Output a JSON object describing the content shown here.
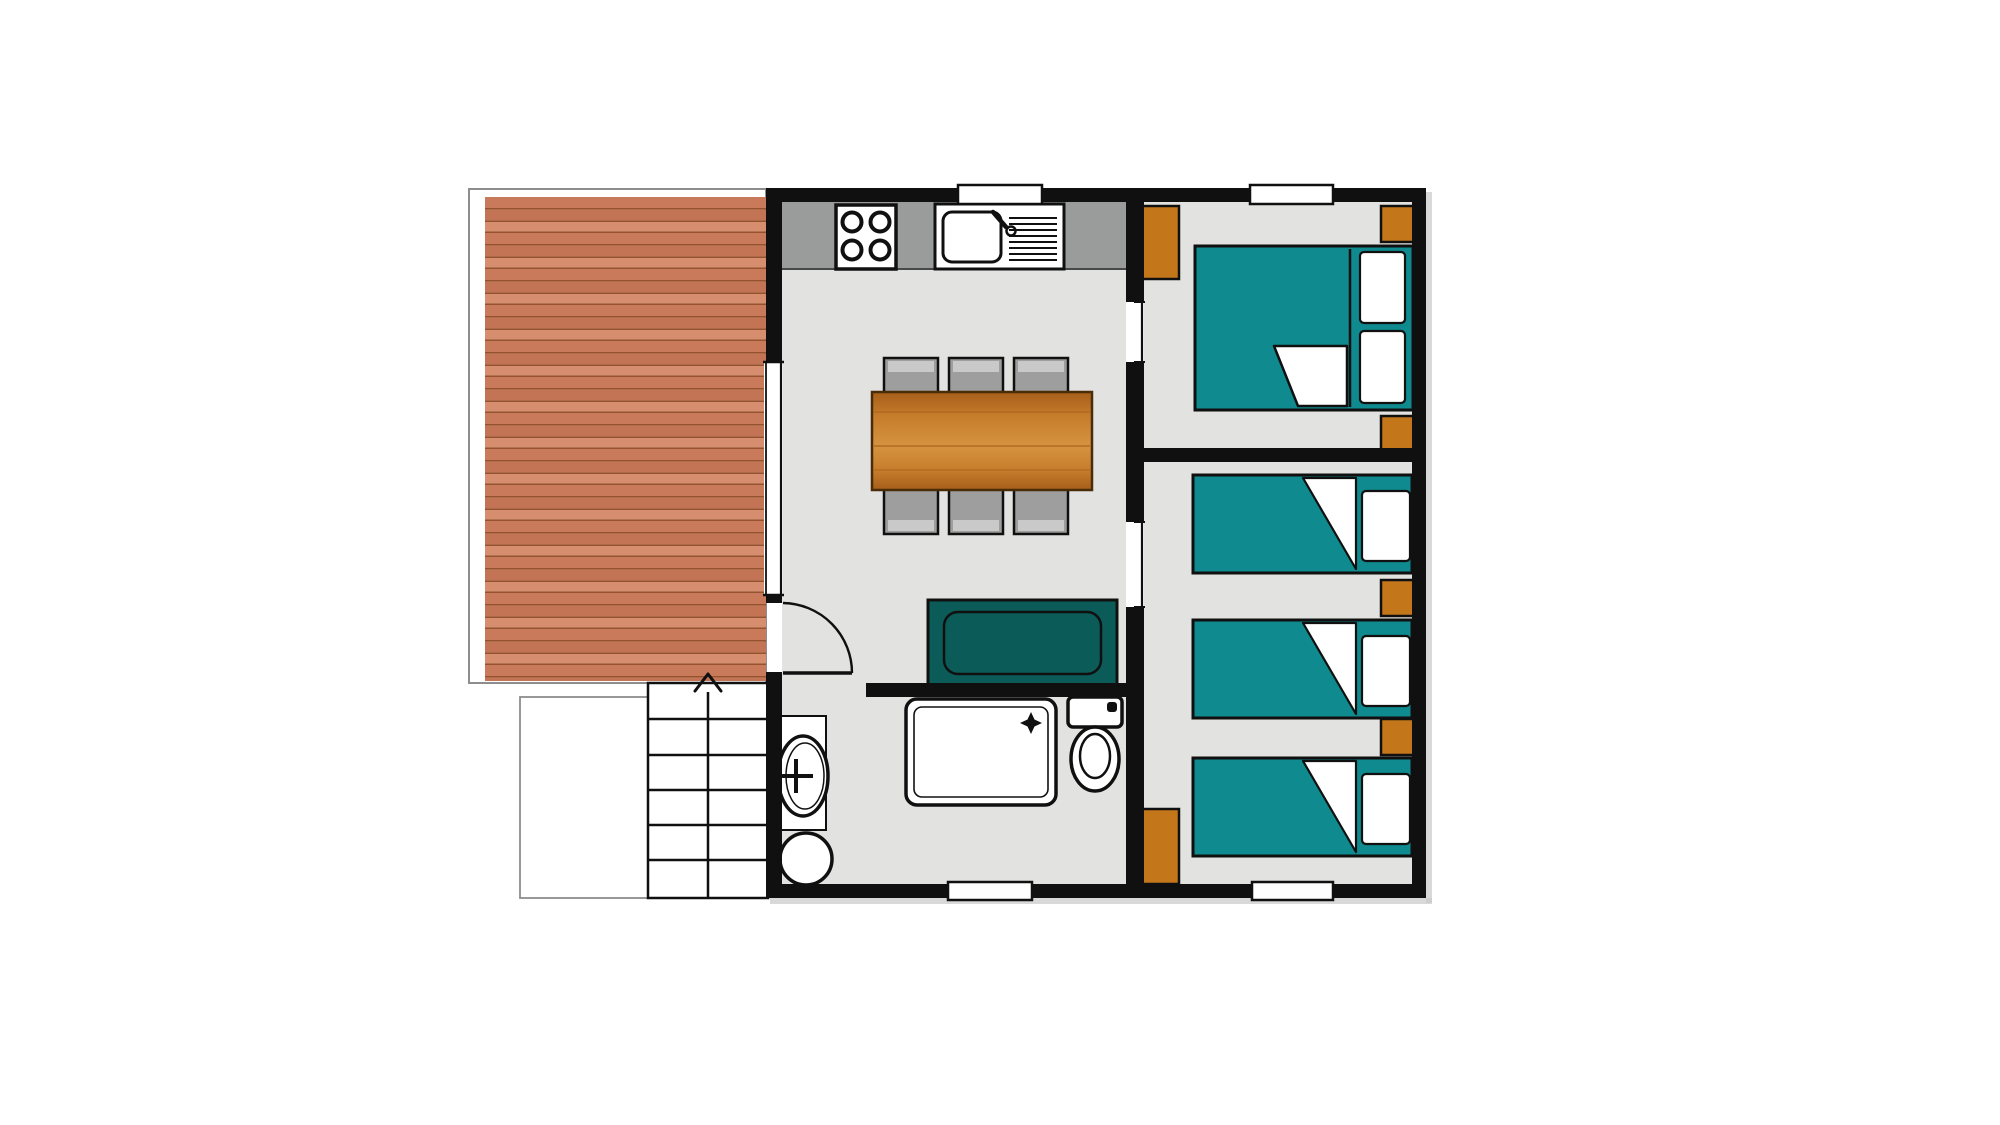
{
  "colors": {
    "wall": "#101010",
    "floor": "#e2e2e1",
    "counter": "#9a9c9b",
    "chair": "#9e9e9e",
    "chair_highlight": "#c9c9c9",
    "bed_teal": "#0f8a8e",
    "sofa_teal": "#0b5b58",
    "furniture_orange": "#c4761b",
    "wood_light": "#d6933f",
    "wood_mid": "#c67d2c",
    "wood_dark": "#a65e1a",
    "deck_a": "#c87a5b",
    "deck_b": "#c37454",
    "deck_c": "#d68e6e",
    "deck_seam": "#96512f",
    "fixture_white": "#ffffff",
    "outline_gray": "#8d8d8d",
    "shadow": "#c9c9c9"
  },
  "plan": {
    "type": "floor-plan",
    "rooms": [
      "deck",
      "kitchen-dining-living",
      "bathroom",
      "double-bedroom",
      "triple-bedroom"
    ],
    "window_count": 5,
    "door_openings": [
      "entrance-door",
      "double-bedroom-opening",
      "triple-bedroom-opening"
    ],
    "furniture": {
      "deck": [
        "wood-decking",
        "stairs-with-up-arrow",
        "side-landing"
      ],
      "kitchen": [
        "hob-4-burners",
        "sink-with-drainer",
        "counter"
      ],
      "dining": [
        "wood-table",
        "chairs-x6"
      ],
      "living": [
        "sofa"
      ],
      "bathroom": [
        "pedestal-basin",
        "water-heater",
        "shower-tray",
        "toilet"
      ],
      "double_bedroom": [
        "double-bed",
        "pillows-x2",
        "wardrobe",
        "nightstands-x2"
      ],
      "triple_bedroom": [
        "single-beds-x3",
        "pillows-x3",
        "nightstands-x2",
        "wardrobe"
      ]
    }
  }
}
